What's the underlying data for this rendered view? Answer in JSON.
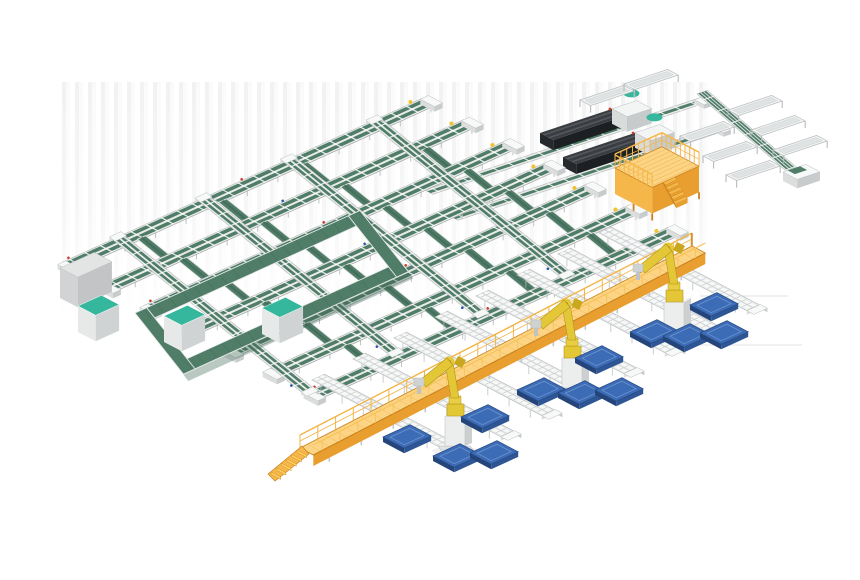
{
  "scene": {
    "width": 860,
    "height": 580,
    "palette": {
      "belt": "#4f7d68",
      "belt_dark": "#3a614f",
      "belt_mid": "#456e5c",
      "teal": "#35b79d",
      "frame_light": "#e9ebeb",
      "frame_mid": "#b9bdbe",
      "frame_dark": "#989ea0",
      "white": "#ffffff",
      "cap_top": "#f7f8f8",
      "cap_left": "#dcdede",
      "cap_right": "#c9cccd",
      "yw_top": "#fcd483",
      "yw_mid": "#f6b74a",
      "yw_side": "#e89f2f",
      "yw_dark": "#c9821f",
      "yw_line": "#ecb85a",
      "robot_y": "#e4c737",
      "robot_yd": "#b2941c",
      "robot_deep": "#c9a81f",
      "blue_top": "#3d6cb6",
      "blue_in": "#6d94cf",
      "blue_mid": "#2e5694",
      "blue_dark": "#24447a",
      "mach_top": "#3a3e42",
      "mach_left": "#26292c",
      "mach_right": "#1d2023",
      "mach_hl": "#55595e",
      "box_top": "#e3e4e4",
      "box_left": "#d2d3d4",
      "box_right": "#c2c4c5",
      "shadow_line": "#e3e3e3",
      "dot_red": "#cf3a26",
      "dot_blue": "#2757b0",
      "cap_yellow": "#f2c22e",
      "roller_tick": "#c9cdce",
      "leg_gray": "#b6babc"
    },
    "axes": {
      "u": [
        0.9,
        -0.41
      ],
      "v": [
        0.885,
        0.465
      ],
      "u2": [
        0.948,
        -0.318
      ],
      "dg": [
        0.757,
        0.653
      ],
      "wk": [
        0.889,
        -0.458
      ],
      "vl": [
        0.62,
        0.785
      ],
      "vx": [
        0.78,
        0.63
      ]
    },
    "floor_lines": [
      [
        700,
        296,
        788
      ],
      [
        678,
        345,
        802
      ]
    ],
    "conveyor_grid": {
      "origin": [
        63,
        262
      ],
      "row_step": [
        41,
        21.5
      ],
      "rows": 7,
      "length": 400,
      "width": 15,
      "cross_offsets": [
        55,
        150,
        245,
        340
      ],
      "cross_length": 245,
      "chute_offsets": [
        70,
        160,
        250,
        340
      ]
    },
    "buffer_loop": {
      "origin": [
        135,
        313
      ],
      "len_u": 250,
      "len_v": 78,
      "band": 13
    },
    "gray_cabinet": {
      "origin": [
        60,
        268
      ],
      "len_u": 38,
      "len_v": 20,
      "h": 30
    },
    "teal_cabinets": [
      [
        78,
        306
      ],
      [
        164,
        316
      ],
      [
        262,
        308
      ]
    ],
    "feed_rails": [
      {
        "a": [
          425,
          190
        ],
        "len": 288
      },
      {
        "a": [
          450,
          216
        ],
        "len": 282
      }
    ],
    "machines": [
      [
        540,
        133
      ],
      [
        563,
        157
      ]
    ],
    "sorter_diagonal": {
      "a": [
        697,
        94
      ],
      "len": 132,
      "band": 11,
      "end_unit": [
        783,
        172
      ]
    },
    "tray_tables": {
      "len": 46,
      "anchors": [
        [
          680,
          136
        ],
        [
          703,
          156
        ],
        [
          726,
          175
        ],
        [
          728,
          110
        ],
        [
          751,
          130
        ],
        [
          773,
          150
        ],
        [
          580,
          100
        ],
        [
          624,
          84
        ]
      ]
    },
    "operator_platform": {
      "origin": [
        615,
        168
      ],
      "len_u": 52,
      "len_v": 42,
      "h": 26
    },
    "walkway": {
      "a": [
        300,
        448
      ],
      "len": 441,
      "w": 15,
      "h": 11,
      "post_gap": 20,
      "stair_steps": 6
    },
    "stub_conveyors": {
      "a0": [
        312,
        380
      ],
      "step": [
        41,
        -21
      ],
      "count": 8,
      "len": 172,
      "width": 14
    },
    "robots": [
      [
        456,
        448
      ],
      [
        573,
        390
      ],
      [
        675,
        334
      ]
    ],
    "pallets": [
      [
        690,
        305
      ],
      [
        630,
        332
      ],
      [
        663,
        336
      ],
      [
        700,
        333
      ],
      [
        575,
        358
      ],
      [
        517,
        390
      ],
      [
        558,
        393
      ],
      [
        595,
        390
      ],
      [
        461,
        417
      ],
      [
        383,
        437
      ],
      [
        433,
        456
      ],
      [
        470,
        453
      ]
    ],
    "pallet_size": {
      "lu": 30,
      "lv": 24,
      "h": 5
    }
  }
}
